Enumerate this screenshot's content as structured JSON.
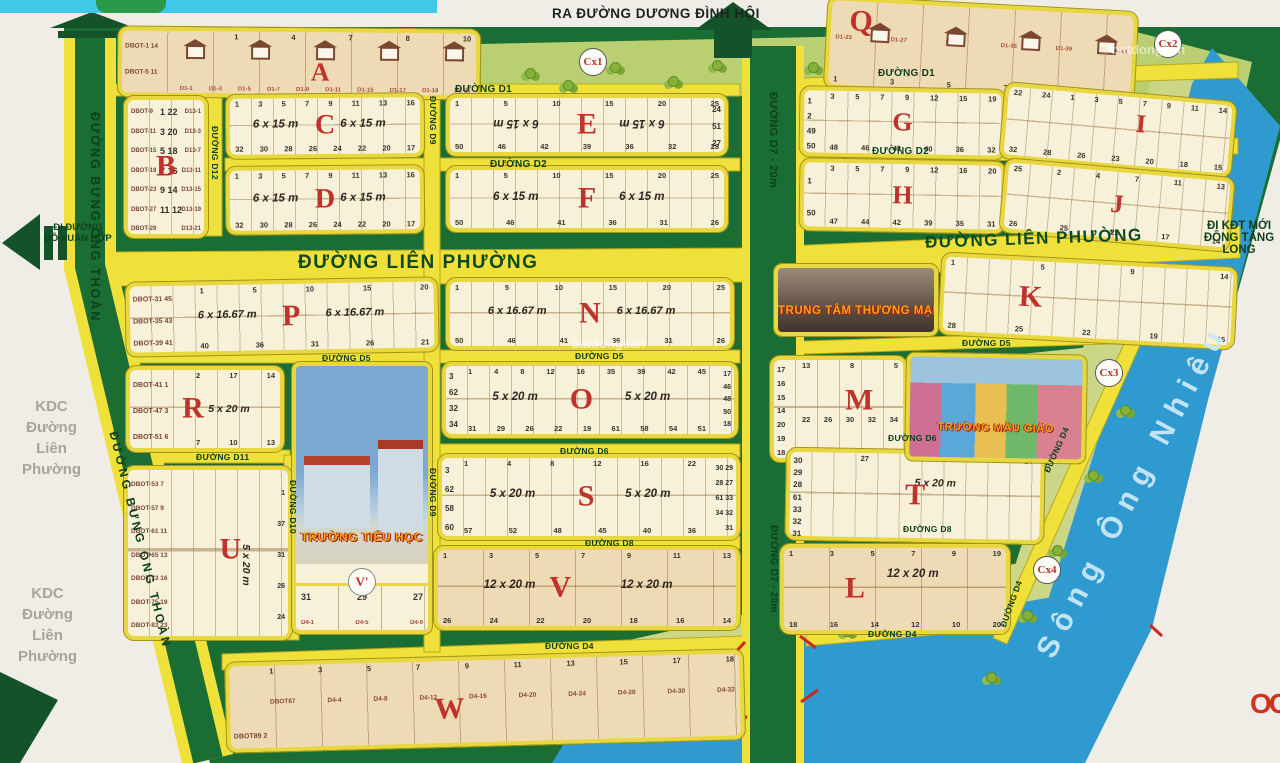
{
  "labels": {
    "exit_top": "RA ĐƯỜNG DƯƠNG ĐÌNH HỘI",
    "exit_left": "ĐI ĐƯỜNG\nĐỖ XUÂN HỢP",
    "exit_right": "ĐI KĐT MỚI\nĐÔNG TĂNG LONG",
    "kdc": "KDC\nĐường\nLiên\nPhường",
    "river": "Sông Ông Nhiêu",
    "watermark": "batdongsan",
    "logo_partial": "OO"
  },
  "roads": {
    "lien_phuong": "ĐƯỜNG LIÊN PHƯỜNG",
    "bung_ong_thoan": "ĐƯỜNG BƯNG ÔNG THOÀN",
    "d7": "ĐƯỜNG D7 - 20m",
    "d1": "ĐƯỜNG D1",
    "d2": "ĐƯỜNG D2",
    "d4": "ĐƯỜNG D4",
    "d5": "ĐƯỜNG D5",
    "d6": "ĐƯỜNG D6",
    "d8": "ĐƯỜNG D8",
    "d9": "ĐƯỜNG D9",
    "d10": "ĐƯỜNG D10",
    "d11": "ĐƯỜNG D11",
    "d12": "ĐƯỜNG D12"
  },
  "parks": {
    "cx1": "Cx1",
    "cx2": "Cx2",
    "cx3": "Cx3",
    "cx4": "Cx4"
  },
  "landmarks": {
    "school": "TRƯỜNG TIỂU HỌC",
    "mall": "TRUNG TÂM THƯƠNG MẠI",
    "kindergarten": "TRƯỜNG MẪU GIÁO"
  },
  "colors": {
    "map_green": "#1b6e33",
    "road_yellow": "#f0e03a",
    "river_blue": "#2f9ad0",
    "block_cream": "#f7f1da",
    "block_tan": "#eedbb6",
    "letter_red": "#c0322b"
  },
  "blocks": {
    "A": {
      "letter": "A",
      "colL": "DBOT-1 14\nDBOT-5 11",
      "top": "1 4 7 8 10",
      "bottom": "D1-1 D1-3 D1-5 D1-7 D1-9 D1-11 D1-15 D1-17 D1-19 D1-21"
    },
    "B": {
      "letter": "B",
      "colL": "DBOT-9\nDBOT-11\nDBOT-15\nDBOT-19\nDBOT-23\nDBOT-27\nDBOT-29",
      "colM": "1 22\n3 20\n5 18\n7 16\n9 14\n11 12",
      "colR": "D13-1\nD13-3\nD13-7\nD13-11\nD13-15\nD13-19\nD13-21"
    },
    "C": {
      "letter": "C",
      "dim1": "6 x 15 m",
      "dim2": "6 x 15 m",
      "top": "1 3 5 7 9 11 13 16",
      "bottom": "32 30 28 26 24 22 20 17"
    },
    "D": {
      "letter": "D",
      "dim1": "6 x 15 m",
      "dim2": "6 x 15 m",
      "top": "1 3 5 7 9 11 13 16",
      "bottom": "32 30 28 26 24 22 20 17"
    },
    "E": {
      "letter": "E",
      "dim1": "6 x 15 m",
      "dim2": "6 x 15 m",
      "top": "1 5 10 15 20 25",
      "bottom": "50 46 42 39 36 32 28",
      "colR": "24\n51\n27"
    },
    "F": {
      "letter": "F",
      "dim1": "6 x 15 m",
      "dim2": "6 x 15 m",
      "top": "1 5 10 15 20 25",
      "bottom": "50 46 41 36 31 26"
    },
    "G": {
      "letter": "G",
      "colL": "1\n2\n49\n50",
      "top": "3 5 7 9 12 15 19",
      "bottom": "48 46 43 40 36 32"
    },
    "H": {
      "letter": "H",
      "colL": "1\n50",
      "top": "3 5 7 9 12 16 20",
      "bottom": "47 44 42 39 35 31"
    },
    "I": {
      "letter": "I",
      "top": "22 24 1 3 5 7 9 11 14",
      "bottom": "32 28 26 23 20 18 15"
    },
    "J": {
      "letter": "J",
      "top": "25 2 4 7 11 13",
      "bottom": "26 25 21 17 14"
    },
    "K": {
      "letter": "K",
      "top": "1 5 9 14",
      "bottom": "28 25 22 19 15"
    },
    "L": {
      "letter": "L",
      "dim1": "12 x 20 m",
      "top": "1 3 5 7 9 19",
      "bottom": "18 16 14 12 10 20"
    },
    "M": {
      "letter": "M",
      "colL": "17\n16\n15\n14\n20\n19\n18",
      "top": "13 8 5",
      "mid": "22 26 30 32 34"
    },
    "N": {
      "letter": "N",
      "dim1": "6 x 16.67 m",
      "dim2": "6 x 16.67 m",
      "top": "1 5 10 15 20 25",
      "bottom": "50 46 41 36 31 26"
    },
    "O": {
      "letter": "O",
      "dim1": "5 x 20 m",
      "dim2": "5 x 20 m",
      "colL": "3\n62\n32\n34",
      "top": "1 4 8 12 16 35 39 42 45",
      "bottom": "31 29 26 22 19 61 58 54 51",
      "colR": "17\n46\n48\n50\n18"
    },
    "P": {
      "letter": "P",
      "dim1": "6 x 16.67 m",
      "dim2": "6 x 16.67 m",
      "colL": "DBOT-31 45\nDBOT-35 43\nDBOT-39 41",
      "top": "1 5 10 15 20",
      "bottom": "40 36 31 26 21"
    },
    "Q": {
      "letter": "Q",
      "mid": "D1-23 D1-27 D1-31 D1-35 D1-39 D1-43",
      "bottom": "1 3 5 7 9 11"
    },
    "R": {
      "letter": "R",
      "dim1": "5 x 20 m",
      "colL": "DBOT-41 1\nDBOT-47 3\nDBOT-51 6",
      "top": "2 17 14",
      "bottom": "7 10 13"
    },
    "S": {
      "letter": "S",
      "dim1": "5 x 20 m",
      "dim2": "5 x 20 m",
      "colL": "3\n62\n58\n60",
      "top": "1 4 8 12 16 22",
      "bottom": "57 52 48 45 40 36",
      "colR": "30 29\n28 27\n61 33\n34 32\n31"
    },
    "T": {
      "letter": "T",
      "dim1": "5 x 20 m",
      "colL": "30\n29\n28\n61\n33\n32\n31",
      "top": "27 24"
    },
    "U": {
      "letter": "U",
      "dim1": "5 x 20 m",
      "colL": "DBOT-53 7\nDBOT-57 9\nDBOT-61 11\nDBOT-65 13\nDBOT-73 16\nDBOT-75 19\nDBOT-83 23",
      "colR": "1\n37\n31\n26\n24"
    },
    "V": {
      "letter": "V",
      "dim1": "12 x 20 m",
      "dim2": "12 x 20 m",
      "top": "1 3 5 7 9 11 13",
      "bottom": "26 24 22 20 18 16 14"
    },
    "Vp": {
      "letter": "V'",
      "nums": "31 29 27",
      "labels": "D4-1 D4-5 D4-9"
    },
    "W": {
      "letter": "W",
      "top": "1 3 5 7 9 11 13 15 17 18",
      "mid": "DBOT87 D4-4 D4-8 D4-12 D4-16 D4-20 D4-24 D4-28 D4-30 D4-32",
      "colL": "DBOT89 2"
    }
  }
}
